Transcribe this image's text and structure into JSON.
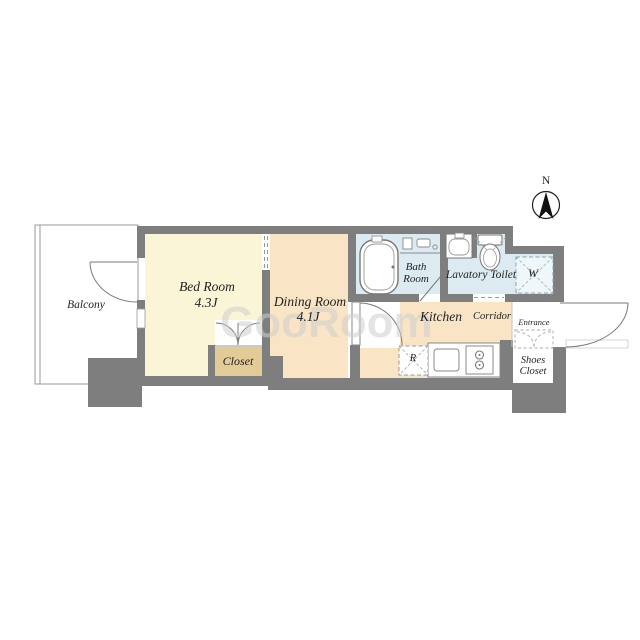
{
  "plan": {
    "compass": {
      "label": "N"
    },
    "watermark": "GooRoom",
    "rooms": {
      "balcony": {
        "label": "Balcony"
      },
      "bed_room": {
        "label": "Bed Room",
        "size": "4.3J"
      },
      "dining_room": {
        "label": "Dining Room",
        "size": "4.1J"
      },
      "closet": {
        "label": "Closet"
      },
      "bath_room": {
        "label": "Bath Room"
      },
      "lavatory_toilet": {
        "label": "Lavatory Toilet"
      },
      "kitchen": {
        "label": "Kitchen"
      },
      "corridor": {
        "label": "Corridor"
      },
      "entrance": {
        "label": "Entrance"
      },
      "shoes_closet": {
        "label": "Shoes Closet"
      },
      "washing_machine": {
        "label": "W"
      },
      "refrigerator": {
        "label": "R"
      }
    },
    "colors": {
      "wall": "#7e7e7e",
      "bedroom_floor": "#FBF5D8",
      "dining_kitchen_floor": "#F9E4C5",
      "closet_floor": "#E2CB96",
      "wet_area_floor": "#DCEBF2",
      "white": "#FFFFFF"
    }
  }
}
